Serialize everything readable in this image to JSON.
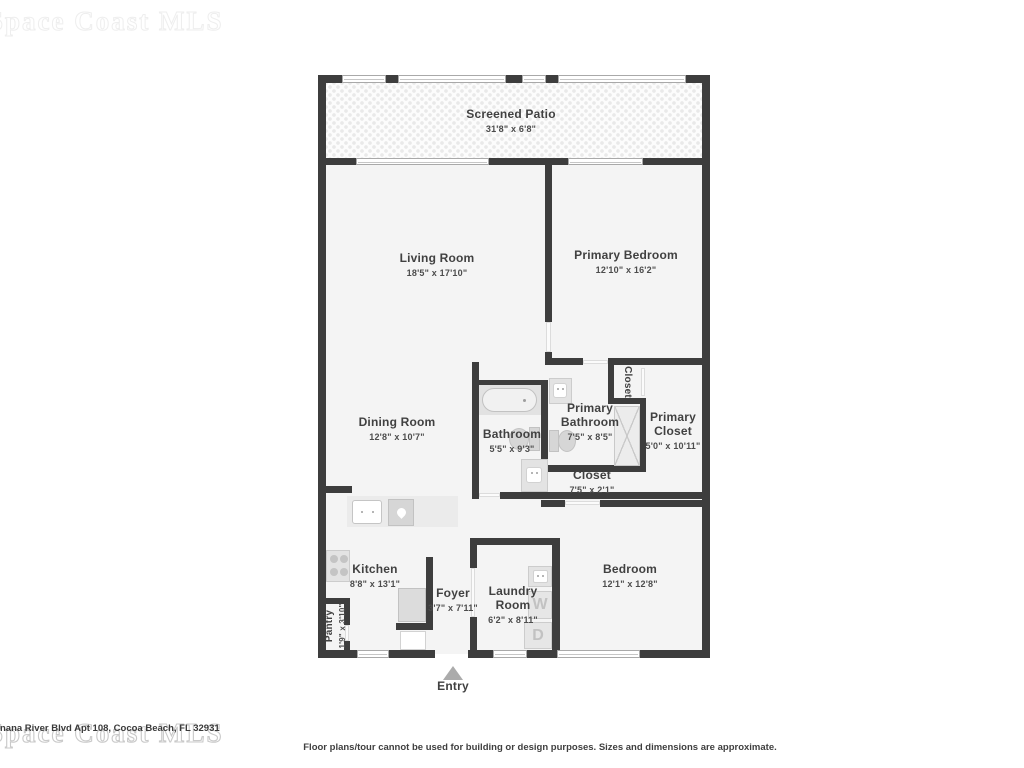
{
  "plan": {
    "rooms": [
      {
        "name": "Screened Patio",
        "dims": "31'8\" x 6'8\""
      },
      {
        "name": "Living Room",
        "dims": "18'5\" x 17'10\""
      },
      {
        "name": "Primary Bedroom",
        "dims": "12'10\" x 16'2\""
      },
      {
        "name": "Dining Room",
        "dims": "12'8\" x 10'7\""
      },
      {
        "name": "Bathroom",
        "dims": "5'5\" x 9'3\""
      },
      {
        "name": "Primary Bathroom",
        "dims": "7'5\" x 8'5\""
      },
      {
        "name": "Closet",
        "dims": ""
      },
      {
        "name": "Primary Closet",
        "dims": "5'0\" x 10'11\""
      },
      {
        "name": "Closet",
        "dims": "7'5\" x 2'1\""
      },
      {
        "name": "Kitchen",
        "dims": "8'8\" x 13'1\""
      },
      {
        "name": "Foyer",
        "dims": "3'7\" x 7'11\""
      },
      {
        "name": "Laundry Room",
        "dims": "6'2\" x 8'11\""
      },
      {
        "name": "Bedroom",
        "dims": "12'1\" x 12'8\""
      },
      {
        "name": "Pantry",
        "dims": "1'9\" x 3'10\""
      }
    ],
    "entry_label": "Entry",
    "washer_letter": "W",
    "dryer_letter": "D"
  },
  "footer": {
    "address": "nana River Blvd Apt 108, Cocoa Beach, FL 32931",
    "watermark": "Space Coast MLS",
    "disclaimer": "Floor plans/tour cannot be used for building or design purposes. Sizes and dimensions are approximate."
  },
  "colors": {
    "wall": "#3d3d3d",
    "floor": "#f4f4f4",
    "fixture": "#e3e3e3",
    "text": "#414141"
  }
}
